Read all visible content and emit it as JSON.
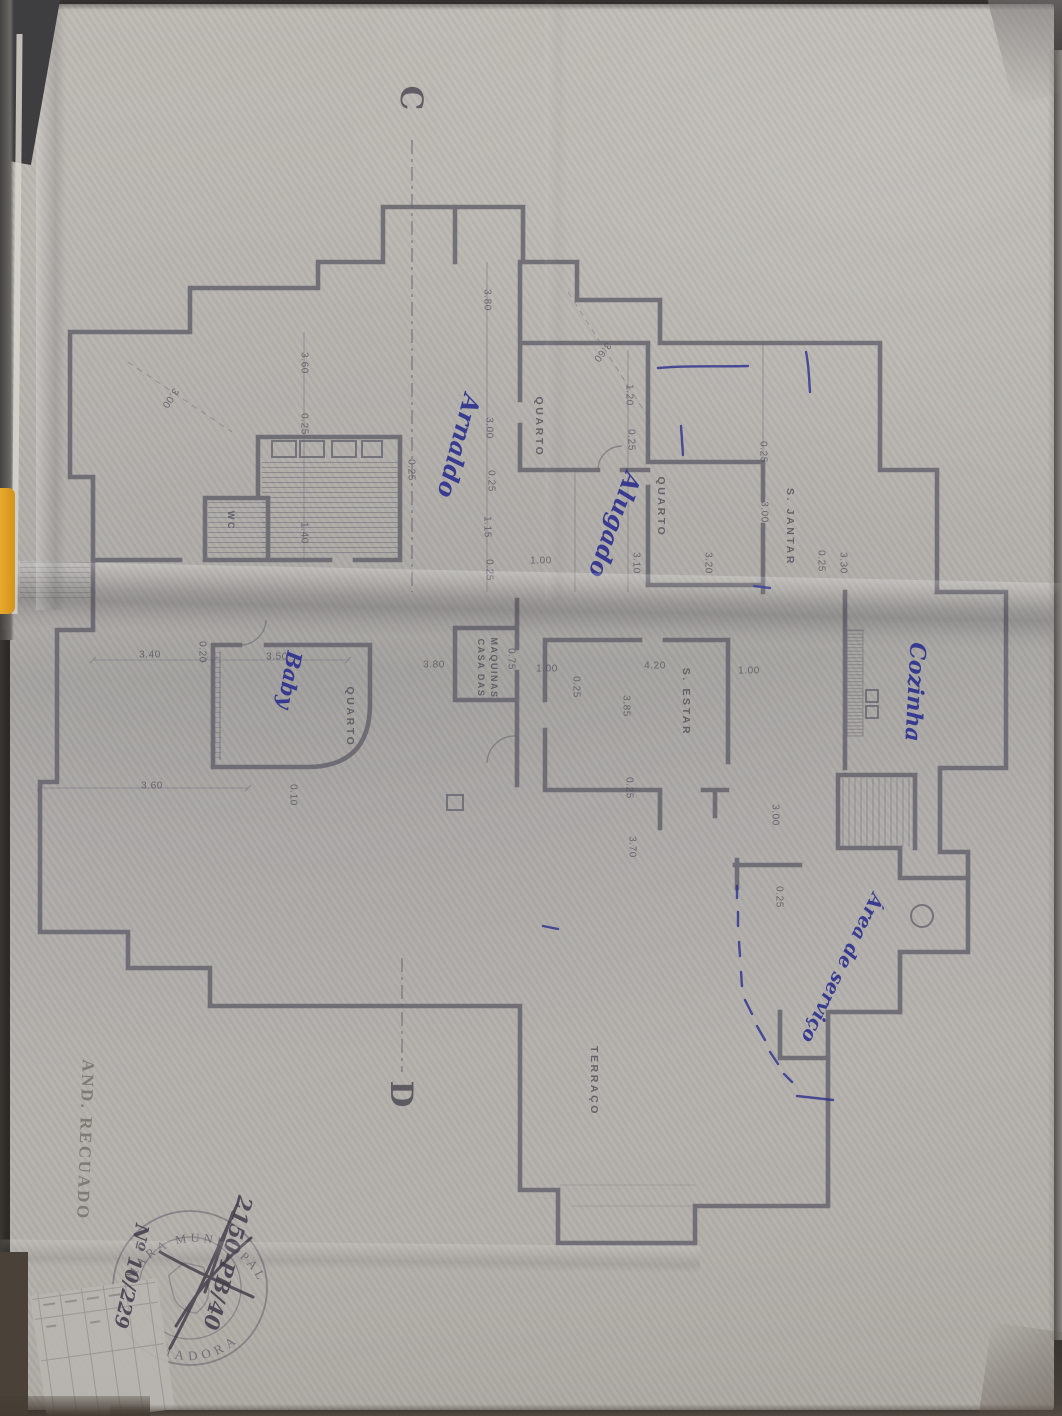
{
  "colors": {
    "ink_blue": "#2b2f8e",
    "pencil": "#7a756d",
    "print": "#5d5b65",
    "stamp": "#5e5665",
    "accent_yellow": "#e9a92d",
    "paper": "#b3b0ab",
    "wall": "#615f6a"
  },
  "plan": {
    "section_markers": [
      {
        "text": "C",
        "x": 411,
        "y": 98,
        "rot": 90
      },
      {
        "text": "D",
        "x": 401,
        "y": 1094,
        "rot": 90
      }
    ],
    "room_labels": [
      {
        "text": "QUARTO",
        "x": 539,
        "y": 427,
        "rot": 90
      },
      {
        "text": "QUARTO",
        "x": 661,
        "y": 507,
        "rot": 90
      },
      {
        "text": "S. JANTAR",
        "x": 790,
        "y": 527,
        "rot": 90
      },
      {
        "text": "WC",
        "x": 231,
        "y": 521,
        "rot": 90,
        "size": 9
      },
      {
        "text": "QUARTO",
        "x": 350,
        "y": 717,
        "rot": 90
      },
      {
        "text": "CASA DAS",
        "x": 481,
        "y": 668,
        "rot": 90,
        "size": 9,
        "ls": 1.5
      },
      {
        "text": "MAQUINAS",
        "x": 494,
        "y": 668,
        "rot": 90,
        "size": 9,
        "ls": 1.5
      },
      {
        "text": "S. ESTAR",
        "x": 686,
        "y": 702,
        "rot": 90
      },
      {
        "text": "TERRAÇO",
        "x": 594,
        "y": 1081,
        "rot": 90
      }
    ],
    "dimension_labels": [
      {
        "text": "3.80",
        "x": 487,
        "y": 300,
        "rot": 90
      },
      {
        "text": "3.00",
        "x": 489,
        "y": 428,
        "rot": 90
      },
      {
        "text": "0.25",
        "x": 491,
        "y": 481,
        "rot": 90
      },
      {
        "text": "1.15",
        "x": 487,
        "y": 527,
        "rot": 90
      },
      {
        "text": "0.25",
        "x": 489,
        "y": 570,
        "rot": 90
      },
      {
        "text": "1.00",
        "x": 541,
        "y": 561,
        "rot": 0
      },
      {
        "text": "3.60",
        "x": 304,
        "y": 363,
        "rot": 90
      },
      {
        "text": "0.25",
        "x": 304,
        "y": 424,
        "rot": 90
      },
      {
        "text": "1.40",
        "x": 304,
        "y": 533,
        "rot": 90
      },
      {
        "text": "0.25",
        "x": 411,
        "y": 470,
        "rot": 90
      },
      {
        "text": "3.00",
        "x": 170,
        "y": 398,
        "rot": 124
      },
      {
        "text": "3.60",
        "x": 602,
        "y": 352,
        "rot": 128
      },
      {
        "text": "1.20",
        "x": 629,
        "y": 395,
        "rot": 90
      },
      {
        "text": "0.25",
        "x": 631,
        "y": 440,
        "rot": 90
      },
      {
        "text": "3.10",
        "x": 636,
        "y": 563,
        "rot": 90
      },
      {
        "text": "3.20",
        "x": 708,
        "y": 563,
        "rot": 90
      },
      {
        "text": "0.25",
        "x": 763,
        "y": 452,
        "rot": 90
      },
      {
        "text": "3.00",
        "x": 764,
        "y": 512,
        "rot": 90
      },
      {
        "text": "0.25",
        "x": 821,
        "y": 561,
        "rot": 90
      },
      {
        "text": "3.30",
        "x": 843,
        "y": 563,
        "rot": 90
      },
      {
        "text": "3.40",
        "x": 150,
        "y": 655,
        "rot": 0
      },
      {
        "text": "0.20",
        "x": 202,
        "y": 652,
        "rot": 90
      },
      {
        "text": "3.50",
        "x": 277,
        "y": 657,
        "rot": 0
      },
      {
        "text": "3.60",
        "x": 152,
        "y": 786,
        "rot": 0
      },
      {
        "text": "0.10",
        "x": 293,
        "y": 795,
        "rot": 90
      },
      {
        "text": "3.80",
        "x": 434,
        "y": 665,
        "rot": 0
      },
      {
        "text": "0.75",
        "x": 511,
        "y": 659,
        "rot": 90
      },
      {
        "text": "1.00",
        "x": 547,
        "y": 669,
        "rot": 0
      },
      {
        "text": "0.25",
        "x": 576,
        "y": 687,
        "rot": 90
      },
      {
        "text": "4.20",
        "x": 655,
        "y": 666,
        "rot": 0
      },
      {
        "text": "1.00",
        "x": 749,
        "y": 671,
        "rot": 0
      },
      {
        "text": "3.85",
        "x": 626,
        "y": 706,
        "rot": 90
      },
      {
        "text": "0.25",
        "x": 629,
        "y": 788,
        "rot": 90
      },
      {
        "text": "3.70",
        "x": 632,
        "y": 847,
        "rot": 90
      },
      {
        "text": "3.00",
        "x": 775,
        "y": 815,
        "rot": 90
      },
      {
        "text": "0.25",
        "x": 779,
        "y": 897,
        "rot": 90
      }
    ]
  },
  "annotations": {
    "ink_notes": [
      {
        "text": "Arnaldo",
        "x": 459,
        "y": 446,
        "rot": 105,
        "size": 24
      },
      {
        "text": "Alugado",
        "x": 615,
        "y": 525,
        "rot": 110,
        "size": 24
      },
      {
        "text": "Cozinha",
        "x": 915,
        "y": 692,
        "rot": 93,
        "size": 22
      },
      {
        "text": "Baby",
        "x": 290,
        "y": 680,
        "rot": 100,
        "size": 21
      },
      {
        "text": "Área de serviço",
        "x": 842,
        "y": 968,
        "rot": 116,
        "size": 19
      }
    ],
    "pencil_notes": [
      {
        "text": "AND. RECUADO",
        "x": 85,
        "y": 1140,
        "rot": 92,
        "size": 17,
        "ls": 2.5
      }
    ],
    "stamp_numbers": [
      {
        "text": "2150-PB/40",
        "x": 228,
        "y": 1263,
        "rot": 105,
        "size": 21
      },
      {
        "text": "Nº 10/229",
        "x": 131,
        "y": 1276,
        "rot": 102,
        "size": 19
      }
    ]
  },
  "stamp": {
    "arc_top": "CÂMARA MUNICIPAL",
    "arc_bottom": "AMADORA"
  }
}
